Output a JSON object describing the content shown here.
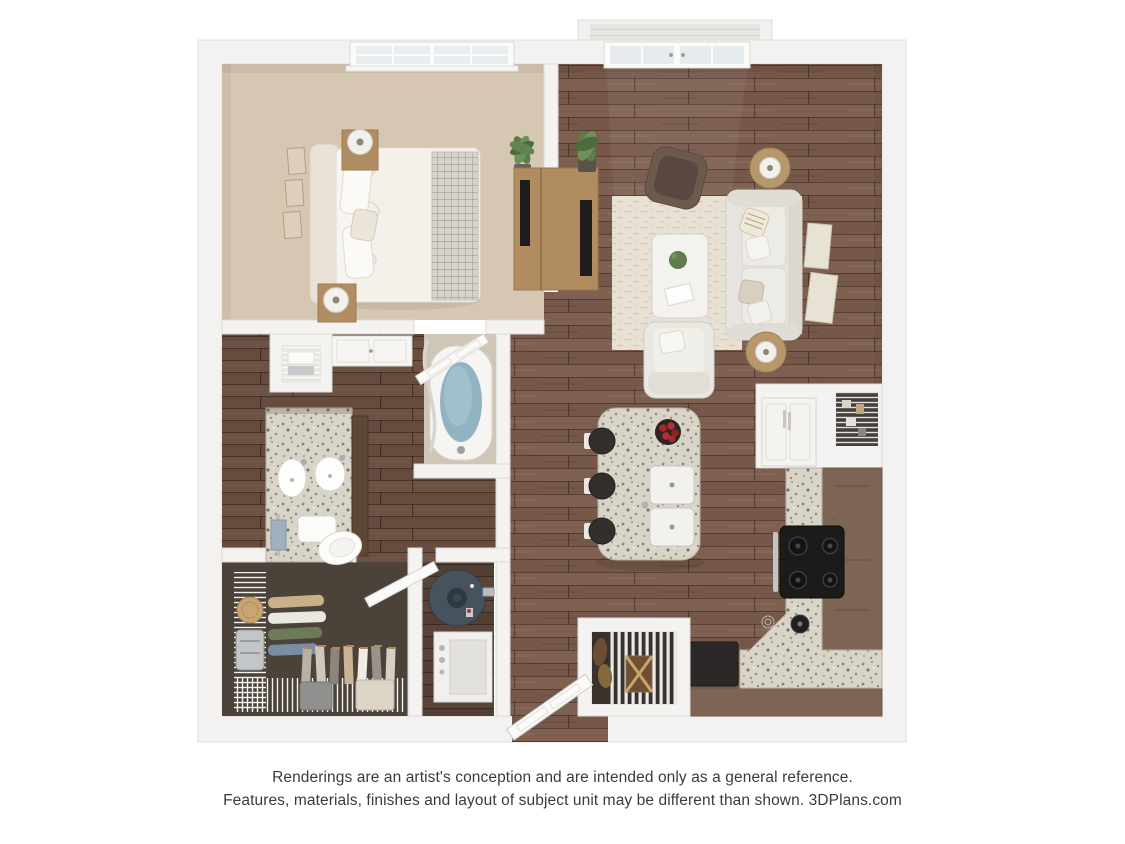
{
  "disclaimer": {
    "line1": "Renderings are an artist's conception and are intended only as a general reference.",
    "line2": "Features, materials, finishes and layout of subject unit may be different than shown. 3DPlans.com"
  },
  "palette": {
    "background": "#ffffff",
    "walls": "#f4f2f0",
    "wall_edge": "#dedbd7",
    "bedroom_carpet": "#d6c7b3",
    "hardwood": "#7a5c4b",
    "hardwood_dark": "#6c5142",
    "closet_carpet": "#4b423a",
    "granite": "#d9d4c8",
    "cabinet_brown": "#7e6454",
    "tub_water": "#92b4c2",
    "water_heater": "#46535f",
    "fruit_red": "#a5282c",
    "text": "#3b3b3b"
  },
  "scene": {
    "type": "3d-floor-plan-rendering",
    "unit": "one-bedroom / one-bath apartment, top-down dollhouse view",
    "rooms": [
      {
        "name": "bedroom",
        "floor": "beige carpet",
        "items": [
          "double window with blinds",
          "upholstered bed with white duvet and knit throw",
          "two wood nightstands with drum lamps",
          "three picture frames on left wall",
          "potted palm plant",
          "media console with tv"
        ]
      },
      {
        "name": "living-room",
        "floor": "dark hardwood",
        "items": [
          "french doors to balcony",
          "balcony",
          "brown accent chair",
          "cream area rug",
          "white coffee table with plant and book",
          "white sofa with four throw pillows",
          "two round wood side tables with lamps",
          "two framed art pieces on right wall",
          "white armchair",
          "tv console with tv",
          "potted plant"
        ]
      },
      {
        "name": "bathroom",
        "floor": "dark hardwood",
        "items": [
          "linen shelves with towels",
          "storage cabinet",
          "granite double-sink vanity",
          "two oval sinks with chrome faucets",
          "toilet",
          "towel bar with blue towel",
          "soaking tub with water",
          "shower curtain",
          "open door"
        ]
      },
      {
        "name": "walk-in-closet",
        "floor": "dark carpet",
        "items": [
          "white wire shelving",
          "hanging clothes",
          "round hat box",
          "metal hamper",
          "two storage baskets",
          "open door"
        ]
      },
      {
        "name": "utility-closet",
        "items": [
          "round-top water heater",
          "stacked washer dryer"
        ]
      },
      {
        "name": "kitchen",
        "floor": "dark hardwood",
        "items": [
          "granite island with double sink",
          "bowl of red apples",
          "three black bar stools",
          "l-shaped granite counter with brown cabinets",
          "black range with four burners",
          "white refrigerator cabinet",
          "pantry nook with wire shelves",
          "black dishwasher front",
          "pot on counter"
        ]
      },
      {
        "name": "entry",
        "items": [
          "open front door",
          "coat closet with louvered front and wicker basket",
          "black entry bench"
        ]
      }
    ]
  }
}
